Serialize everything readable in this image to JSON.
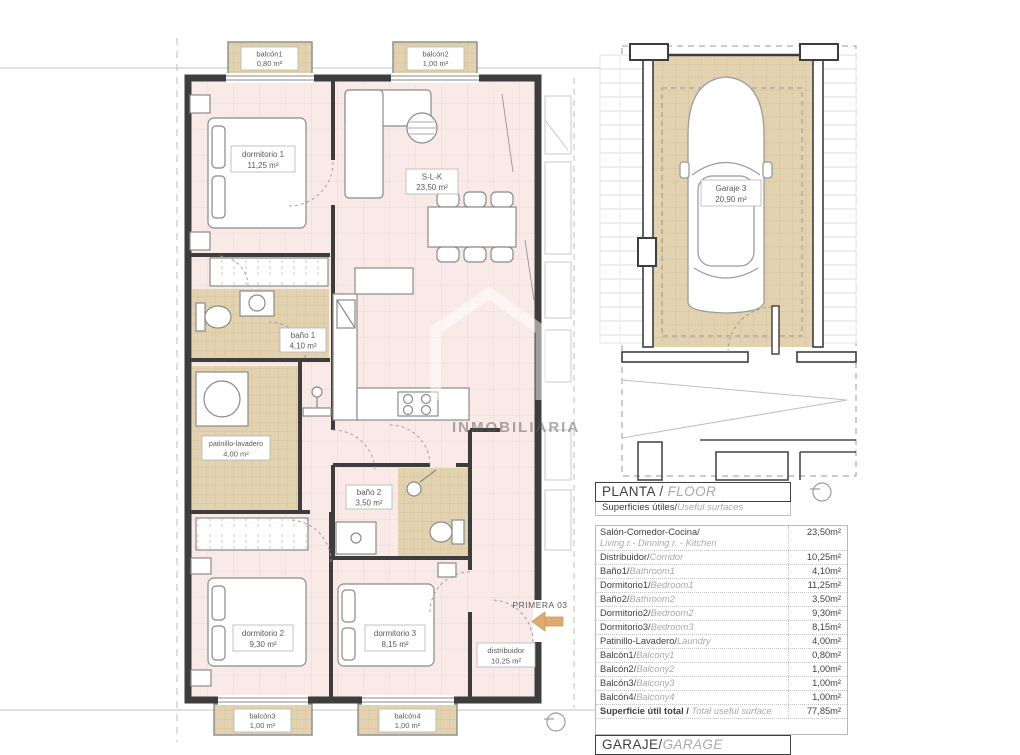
{
  "plan": {
    "rooms": [
      {
        "name": "dormitorio 1",
        "area": "11,25 m²"
      },
      {
        "name": "S-L-K",
        "area": "23,50 m²"
      },
      {
        "name": "baño 1",
        "area": "4,10 m²"
      },
      {
        "name": "patinillo-lavadero",
        "area": "4,00 m²"
      },
      {
        "name": "baño 2",
        "area": "3,50 m²"
      },
      {
        "name": "dormitorio 2",
        "area": "9,30 m²"
      },
      {
        "name": "dormitorio 3",
        "area": "8,15 m²"
      },
      {
        "name": "distribuidor",
        "area": "10,25 m²"
      }
    ],
    "balconies": [
      {
        "name": "balcón1",
        "area": "0,80 m²"
      },
      {
        "name": "balcón2",
        "area": "1,00 m²"
      },
      {
        "name": "balcón3",
        "area": "1,00 m²"
      },
      {
        "name": "balcón4",
        "area": "1,00 m²"
      }
    ],
    "unit_label": "PRIMERA 03"
  },
  "garage": {
    "name": "Garaje 3",
    "area": "20,90 m²"
  },
  "watermark": {
    "text": "INMOBILIARIA"
  },
  "colors": {
    "room_fill": "#f9eae8",
    "tile_fill": "#e3d2b0",
    "wall": "#3d3d3d",
    "arrow": "#ddab6d"
  },
  "table": {
    "title_es": "PLANTA / ",
    "title_en": "FLOOR",
    "subtitle_es": "Superficies útiles/",
    "subtitle_en": "Useful surfaces",
    "rows": [
      {
        "es": "Salón-Comedor-Cocina/",
        "en": "Living r.- Dinning r. - Kitchen",
        "value": "23,50m²"
      },
      {
        "es": "Distribuidor/",
        "en": "Corridor",
        "value": "10,25m²"
      },
      {
        "es": "Baño1/",
        "en": "Bathroom1",
        "value": "4,10m²"
      },
      {
        "es": "Dormitorio1/",
        "en": "Bedroom1",
        "value": "11,25m²"
      },
      {
        "es": "Baño2/",
        "en": "Bathroom2",
        "value": "3,50m²"
      },
      {
        "es": "Dormitorio2/",
        "en": "Bedroom2",
        "value": "9,30m²"
      },
      {
        "es": "Dormitorio3/",
        "en": "Bedroom3",
        "value": "8,15m²"
      },
      {
        "es": "Patinillo-Lavadero/",
        "en": "Laundry",
        "value": "4,00m²"
      },
      {
        "es": "Balcón1/",
        "en": "Balcony1",
        "value": "0,80m²"
      },
      {
        "es": "Balcón2/",
        "en": "Balcony2",
        "value": "1,00m²"
      },
      {
        "es": "Balcón3/",
        "en": "Balcony3",
        "value": "1,00m²"
      },
      {
        "es": "Balcón4/",
        "en": "Balcony4",
        "value": "1,00m²"
      }
    ],
    "total_es": "Superficie útil total / ",
    "total_en": "Total useful surface",
    "total_value": "77,85m²"
  },
  "garage_header": {
    "es": "GARAJE/",
    "en": "GARAGE"
  }
}
